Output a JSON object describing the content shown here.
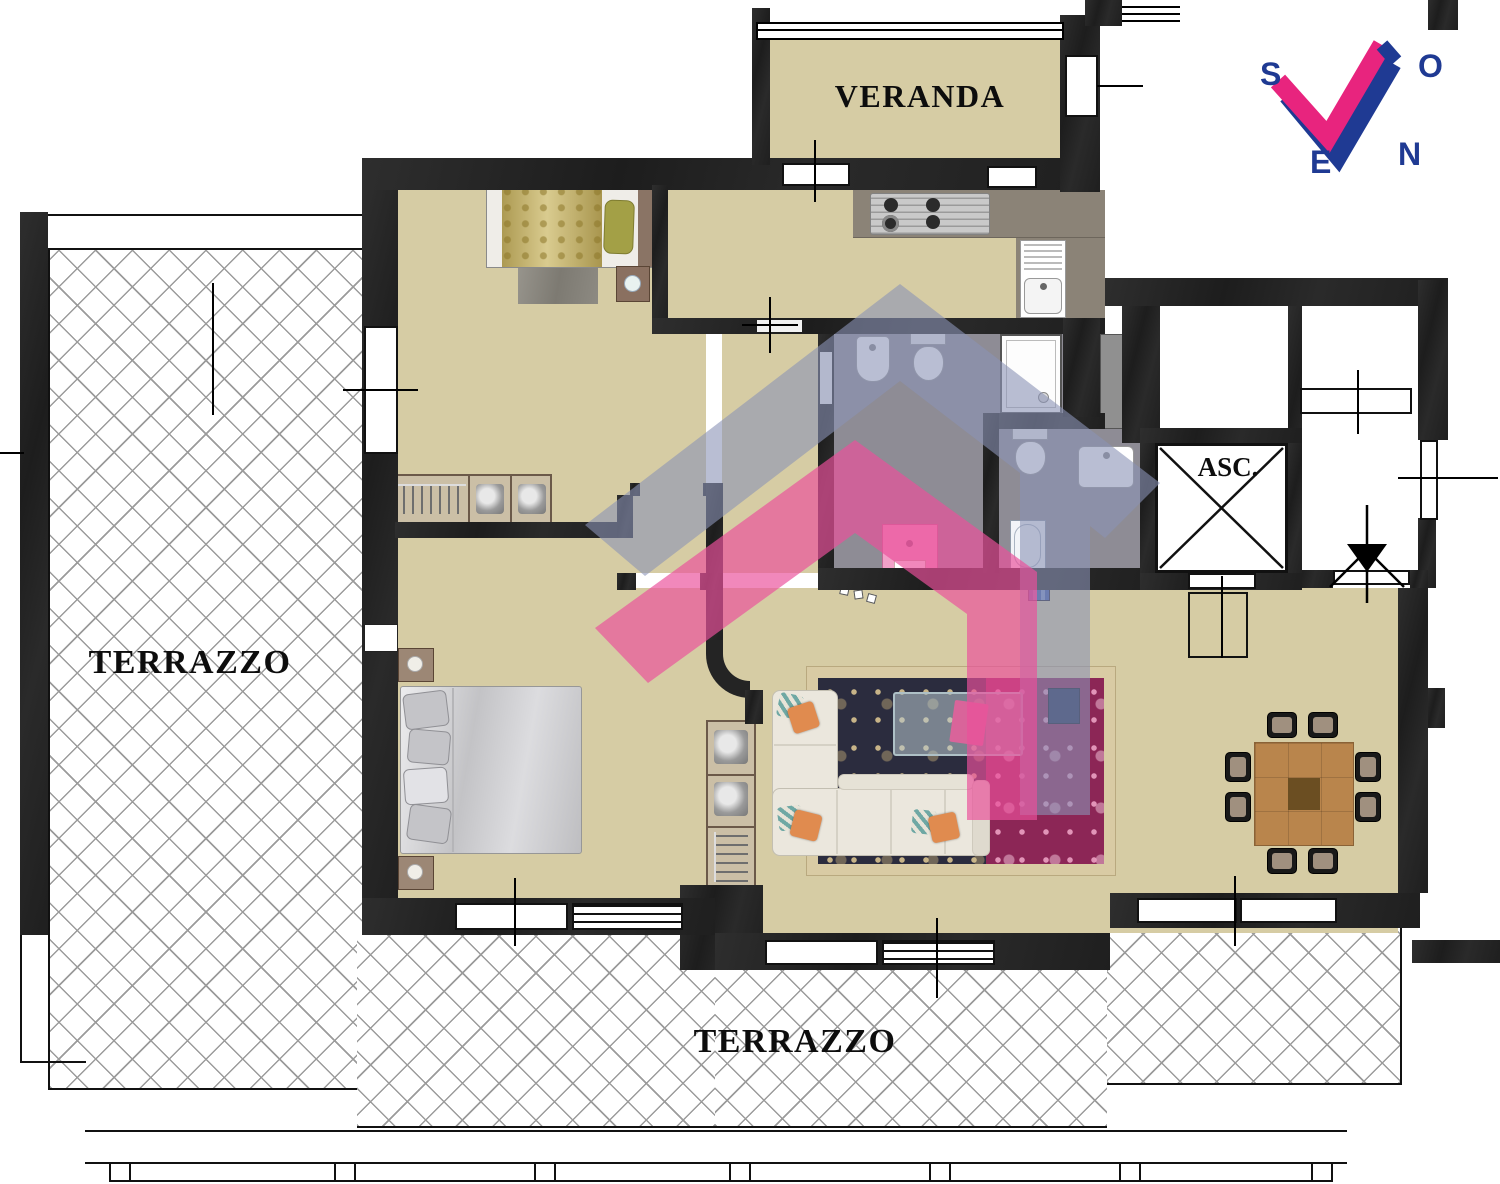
{
  "labels": {
    "veranda": "VERANDA",
    "terrace_left": "TERRAZZO",
    "terrace_bottom": "TERRAZZO",
    "elevator": "ASC."
  },
  "compass": {
    "south": "S",
    "ovest": "O",
    "est": "E",
    "nord": "N"
  },
  "colors": {
    "floor_beige": "#D6CCA4",
    "wall_dark": "#242424",
    "bath_floor_gray": "#8E8C95",
    "kitchen_counter": "#8B8377",
    "logo_blue": "#8A92B6",
    "logo_pink": "#EA4F9B",
    "compass_blue": "#1F3A93",
    "compass_pink": "#E8247E",
    "wood_table": "#B9854C",
    "tile_line_gray": "#9B9B9B"
  }
}
